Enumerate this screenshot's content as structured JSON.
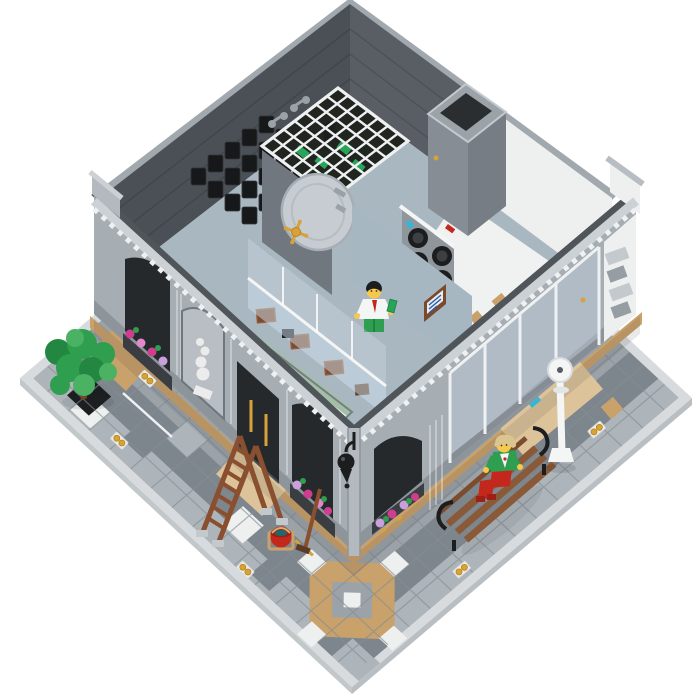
{
  "image": {
    "title": "LEGO brick bank with laundromat - aerial cutaway product photo",
    "background": "#ffffff",
    "alt": "Top-down three-quarter view of a LEGO modular bank building with the roof removed, revealing a vault with a white barred ceiling and round vault door with gold spinner, racks of black safe-deposit boxes, a secretary minifigure behind a glass teller counter, a laundromat with stacked washing machines, and a tiled street-corner plaza with a tree, stepladder, broom, red bucket, park bench with a child minifigure, white lamppost and scattered gold coins."
  },
  "colors": {
    "bg": "#ffffff",
    "curb": "#d7dbdd",
    "plate-side": "#c2c7ca",
    "tile": "#9ba3a9",
    "tile-light": "#aeb5ba",
    "tile-dark": "#7e868d",
    "tile-white": "#eef0f0",
    "tile-line": "#868e94",
    "tan": "#c9a16b",
    "tan-light": "#dcc39a",
    "facade": "#a6adb3",
    "facade-light": "#bac0c5",
    "facade-dark": "#868d94",
    "cornice": "#ccd1d5",
    "dentil": "#eef0f1",
    "plinth": "#8d949a",
    "opening": "#26292c",
    "window-box": "#3a3e42",
    "inner-dark": "#4b5056",
    "inner-dark2": "#585e64",
    "wall-cap": "#a2a9ae",
    "floor-blue": "#a9b7c1",
    "floor-white": "#f0f1f1",
    "white": "#f4f5f5",
    "statue": "#ececec",
    "black": "#1c1d1f",
    "box-black": "#17181a",
    "vault-door": "#c6ccd1",
    "vault-edge": "#a7aeb4",
    "gold": "#d7a13c",
    "gold-dark": "#b8860b",
    "money": "#29a55b",
    "brown": "#7c4a2e",
    "brown-light": "#935a37",
    "bench-brown": "#8a5a38",
    "ladder-brown": "#8a4f2e",
    "trunk": "#7a4526",
    "leaf": "#2f9e4e",
    "leaf-dark": "#238741",
    "leaf-light": "#4bb263",
    "magenta": "#cf3e8e",
    "lavender": "#c9a0dd",
    "pink": "#e287c8",
    "azure": "#35b6d4",
    "blue": "#2a5caa",
    "sign-brown": "#7a4a2c",
    "red": "#c4281c",
    "red-dark": "#9e1f16",
    "teal": "#1b6b6e",
    "skin": "#f7c94a",
    "hair-tan": "#d9c58d",
    "kid-green": "#2f9e50",
    "stripe-green": "#a3bfa6",
    "stripe-base": "#e9ece9",
    "sand-wall": "#a7b7c2"
  },
  "scene": {
    "baseplate": {
      "shape": "square plate seen at isometric angle",
      "tile_grid": "16x16 square tiles",
      "center_motif": "tan and white diamond inlay near front corner",
      "bands": [
        "light tiles along curbs",
        "dark grey road band",
        "medium grey sidewalk near building"
      ],
      "coin_tiles": 5
    },
    "building": {
      "left_wing": "bank facade: fluted pilasters, arched flower window, white statue niche, dark double door with gold handles, arched flower window",
      "right_wing": "bank flower window, then laundromat glass shopfront with gold awning rolls, azure detergent boxes, wall-mounted washer with black round door, quoined white end",
      "interior": [
        "dark grey upper walls with light cap",
        "rows of black safe-deposit boxes",
        "vault with white barred ceiling, green money bills and burglar figure",
        "round vault door with gold spinner handle",
        "grey laundry chute box",
        "stacked dryers with black round doors and red/blue buttons",
        "white laundromat floor with tan tiles",
        "sand-blue office wall with exchange-rate sign",
        "glass teller counter with reddish-brown desk boxes",
        "sand-green striped marble floor"
      ]
    },
    "minifigures": [
      {
        "name": "bank-secretary",
        "hair": "black",
        "face": "yellow",
        "torso": "white shirt with red tie",
        "legs": "green",
        "holding": "green banknote"
      },
      {
        "name": "kid-on-bench",
        "hair": "tan tousled",
        "face": "yellow",
        "torso": "green jacket over white shirt",
        "legs": "red"
      }
    ],
    "props": [
      "green tree on black grate tile",
      "reddish-brown A-frame ladder with grey feet",
      "push broom",
      "red bucket with water",
      "brown park bench with black iron arms",
      "white ornate lamppost",
      "gold coin tiles on pavement"
    ]
  }
}
